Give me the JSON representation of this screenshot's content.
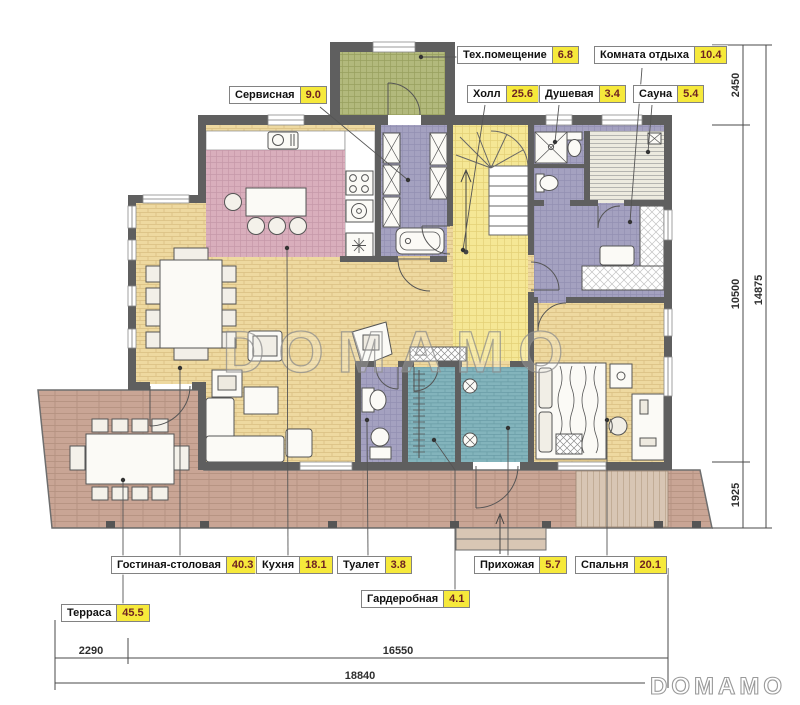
{
  "watermark": {
    "center": "DOMAMO",
    "logo": "DOMAMO"
  },
  "rooms": [
    {
      "id": "service",
      "name": "Сервисная",
      "area": "9.0"
    },
    {
      "id": "tech",
      "name": "Тех.помещение",
      "area": "6.8"
    },
    {
      "id": "rest",
      "name": "Комната отдыха",
      "area": "10.4"
    },
    {
      "id": "hall",
      "name": "Холл",
      "area": "25.6"
    },
    {
      "id": "shower",
      "name": "Душевая",
      "area": "3.4"
    },
    {
      "id": "sauna",
      "name": "Сауна",
      "area": "5.4"
    },
    {
      "id": "living",
      "name": "Гостиная-столовая",
      "area": "40.3"
    },
    {
      "id": "kitchen",
      "name": "Кухня",
      "area": "18.1"
    },
    {
      "id": "toilet",
      "name": "Туалет",
      "area": "3.8"
    },
    {
      "id": "entry",
      "name": "Прихожая",
      "area": "5.7"
    },
    {
      "id": "bedroom",
      "name": "Спальня",
      "area": "20.1"
    },
    {
      "id": "wardrobe",
      "name": "Гардеробная",
      "area": "4.1"
    },
    {
      "id": "terrace",
      "name": "Терраса",
      "area": "45.5"
    }
  ],
  "dimensions": {
    "bottom": [
      "2290",
      "16550",
      "18840"
    ],
    "right": [
      "2450",
      "10500",
      "1925",
      "14875"
    ]
  },
  "colors": {
    "wall": "#5f5f5f",
    "area_chip": "#f6e93b",
    "area_text": "#6e2222",
    "floor_wood": "#eed9a0",
    "floor_kitchen": "#d9aebc",
    "floor_tech": "#b2b97c",
    "floor_utility": "#a4a1c0",
    "floor_hall": "#f5e795",
    "floor_wardrobe": "#83b4bc",
    "deck": "#c9a595"
  }
}
